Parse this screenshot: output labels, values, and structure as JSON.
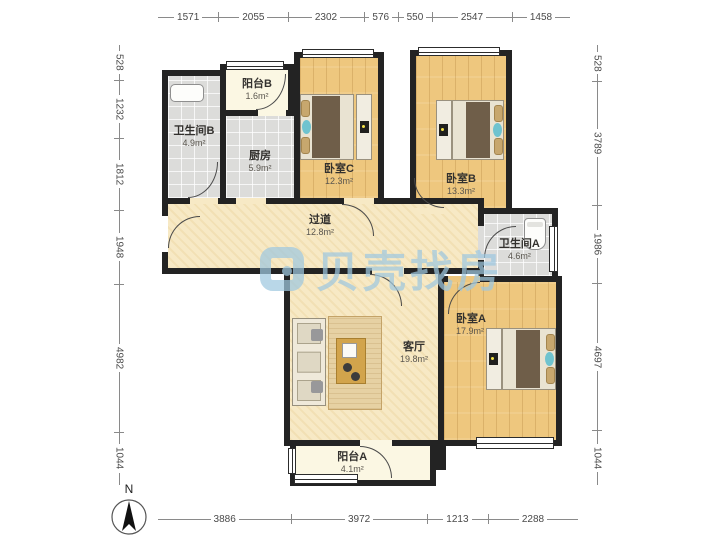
{
  "meta": {
    "watermark": "贝壳找房",
    "compass_label": "N"
  },
  "colors": {
    "wall": "#232323",
    "wood_floor": "#eec77e",
    "tile_floor": "#dcdcda",
    "hall_floor": "#f7e9c5",
    "balcony_floor": "#fbf7e3",
    "watermark_blue": "#9fc8e0",
    "bed_duvet": "#6f5e49",
    "accent_teal": "#6fc3cf"
  },
  "rooms": {
    "balcony_b": {
      "name": "阳台B",
      "area": "1.6m²"
    },
    "bathroom_b": {
      "name": "卫生间B",
      "area": "4.9m²"
    },
    "kitchen": {
      "name": "厨房",
      "area": "5.9m²"
    },
    "bedroom_c": {
      "name": "卧室C",
      "area": "12.3m²"
    },
    "bedroom_b": {
      "name": "卧室B",
      "area": "13.3m²"
    },
    "corridor": {
      "name": "过道",
      "area": "12.8m²"
    },
    "bathroom_a": {
      "name": "卫生间A",
      "area": "4.6m²"
    },
    "bedroom_a": {
      "name": "卧室A",
      "area": "17.9m²"
    },
    "living": {
      "name": "客厅",
      "area": "19.8m²"
    },
    "balcony_a": {
      "name": "阳台A",
      "area": "4.1m²"
    }
  },
  "dims": {
    "top": [
      "1571",
      "2055",
      "2302",
      "576",
      "550",
      "2547",
      "1458"
    ],
    "bottom": [
      "3886",
      "3972",
      "1213",
      "2288"
    ],
    "left": [
      "528",
      "1232",
      "1812",
      "1948",
      "4982",
      "1044"
    ],
    "right": [
      "528",
      "3789",
      "1986",
      "4697",
      "1044"
    ]
  }
}
